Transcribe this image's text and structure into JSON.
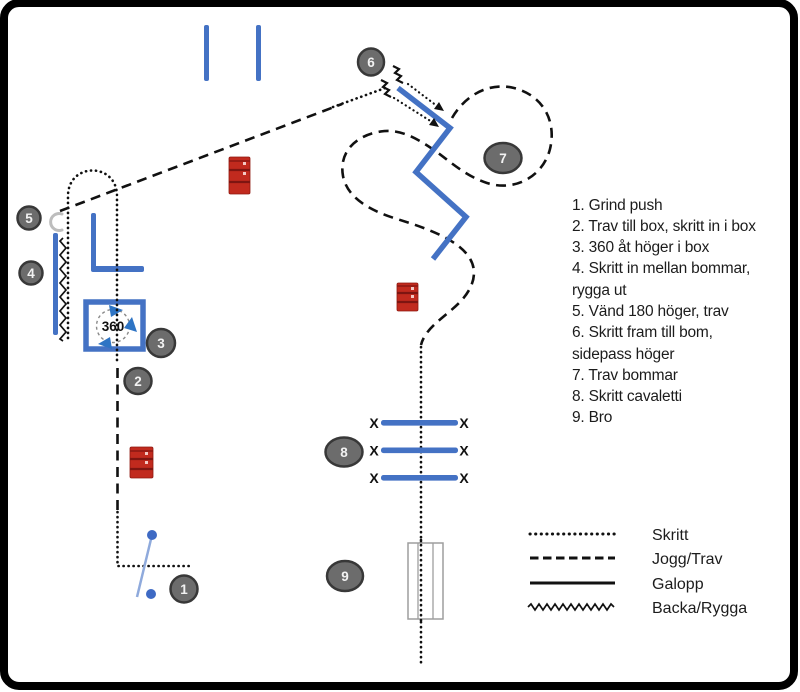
{
  "instructions": {
    "lines": [
      "1. Grind push",
      "2. Trav till box, skritt in i box",
      "3. 360 åt höger i box",
      "4. Skritt in mellan bommar,",
      "rygga ut",
      "5. Vänd 180 höger, trav",
      "6. Skritt fram till bom,",
      "sidepass höger",
      "7. Trav bommar",
      "8. Skritt cavaletti",
      "9. Bro"
    ]
  },
  "legend": {
    "items": [
      {
        "label": "Skritt",
        "line_style": "dotted"
      },
      {
        "label": "Jogg/Trav",
        "line_style": "dashed"
      },
      {
        "label": "Galopp",
        "line_style": "solid"
      },
      {
        "label": "Backa/Rygga",
        "line_style": "zigzag"
      }
    ]
  },
  "badges": [
    {
      "number": "1"
    },
    {
      "number": "2"
    },
    {
      "number": "3"
    },
    {
      "number": "4"
    },
    {
      "number": "5"
    },
    {
      "number": "6"
    },
    {
      "number": "7"
    },
    {
      "number": "8"
    },
    {
      "number": "9"
    }
  ],
  "obstacles": {
    "box360_label": "360",
    "cavaletti_end_marker": "X"
  },
  "colors": {
    "pole_blue": "#4472C4",
    "gate_blue": "#8FAADC",
    "gate_dot_blue": "#3E6AC4",
    "barrel_red": "#C12A1E",
    "badge_fill": "#6C6C6C",
    "path_color": "#111111"
  }
}
